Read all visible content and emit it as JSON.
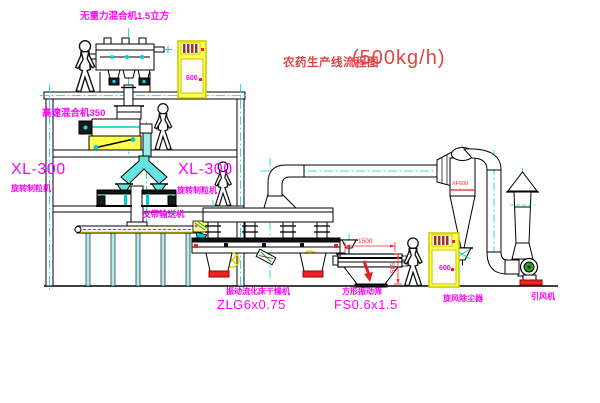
{
  "title": {
    "main": "农药生产线流程图",
    "capacity": "(500kg/h)"
  },
  "labels": {
    "gravity_free_mixer": "无重力混合机1.5立方",
    "high_speed_mixer": "高速混合机350",
    "granulator_left_model": "XL-300",
    "granulator_left_name": "旋转制粒机",
    "granulator_right_model": "XL-300",
    "granulator_right_name": "旋转制粒机",
    "belt_conveyor": "皮带输送机",
    "dryer_name": "振动流化床干燥机",
    "dryer_model": "ZLG6x0.75",
    "sieve_name": "方形振动筛",
    "sieve_model": "FS0.6x1.5",
    "cyclone": "旋风除尘器",
    "induced_fan": "引风机"
  },
  "dimensions": {
    "sieve_length": "1500",
    "sieve_height": "545",
    "cyclone_mark": "XF600"
  },
  "cabinets": {
    "cabinet_a_text": "600",
    "cabinet_b_text": "600"
  },
  "colors": {
    "label_magenta": "#ff00ff",
    "title_red": "#e04545",
    "centerline_cyan": "#00d4d4",
    "cabinet_yellow": "#ffff4d",
    "dimension_red": "#ff2020",
    "line_black": "#000000"
  }
}
